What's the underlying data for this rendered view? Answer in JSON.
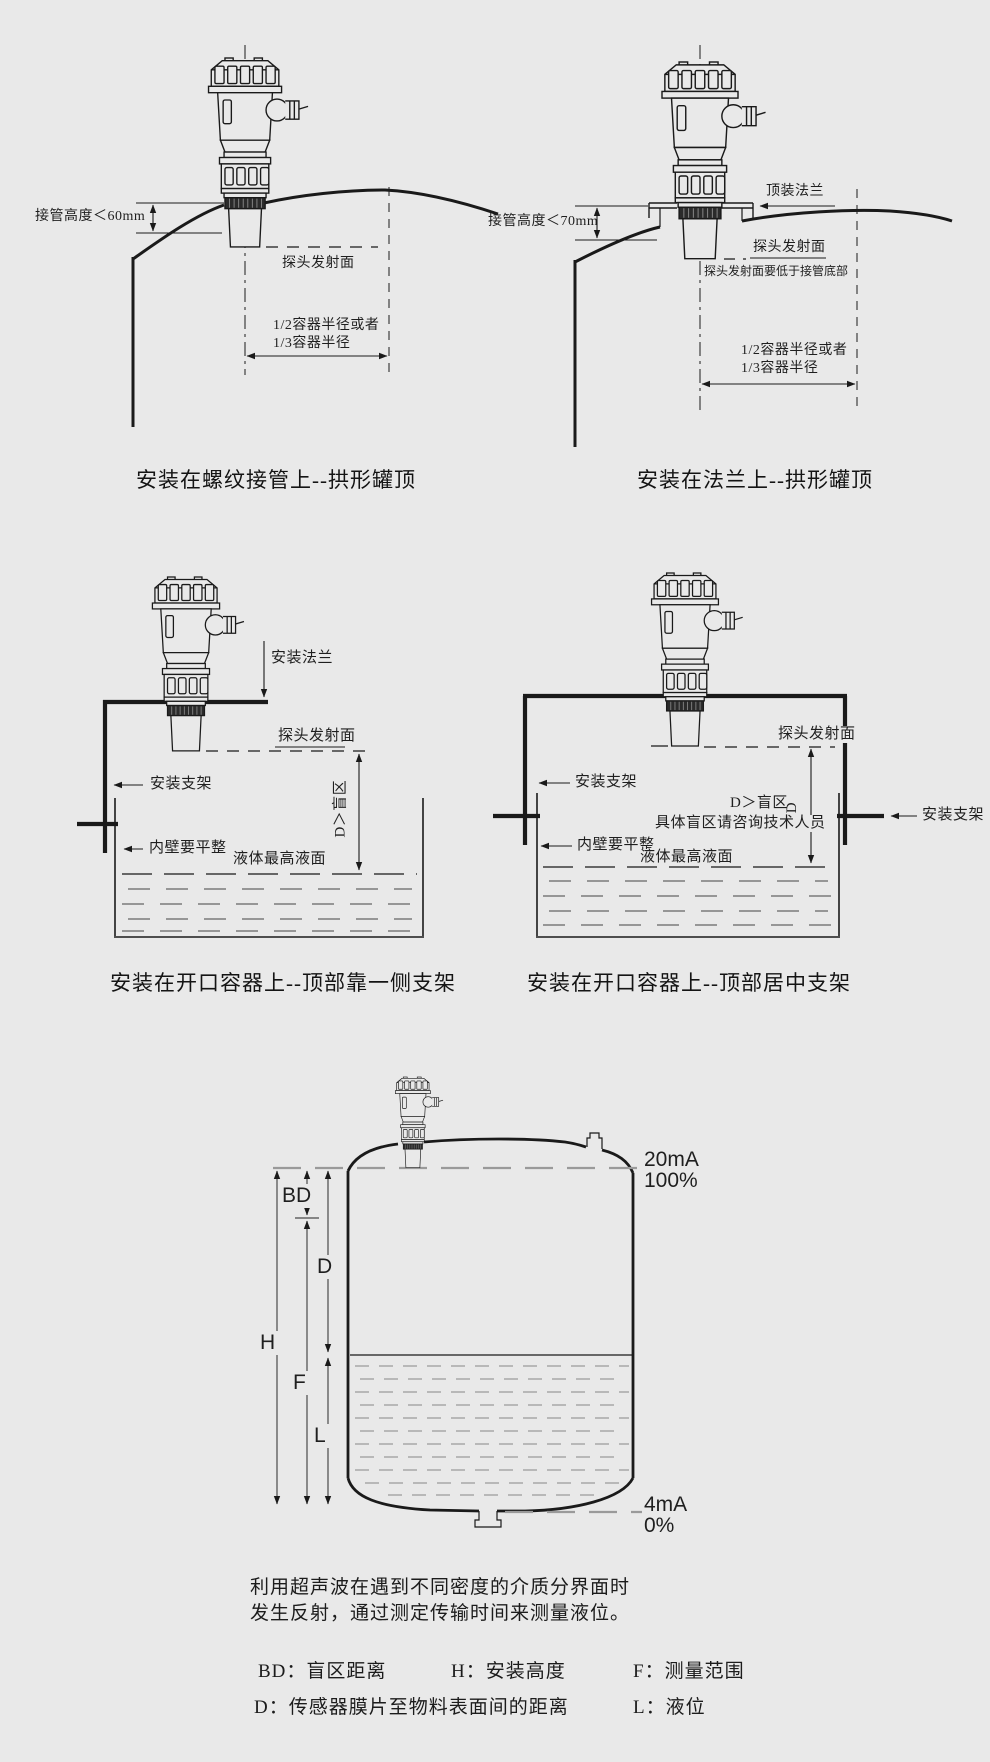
{
  "colors": {
    "background": "#e9e9e9",
    "line": "#1a1a1a",
    "text": "#1f1f1f"
  },
  "diagrams": {
    "top_left": {
      "caption": "安装在螺纹接管上--拱形罐顶",
      "pipe_height": "接管高度＜60mm",
      "probe_surface": "探头发射面",
      "radius_line1": "1/2容器半径或者",
      "radius_line2": "1/3容器半径"
    },
    "top_right": {
      "caption": "安装在法兰上--拱形罐顶",
      "top_flange": "顶装法兰",
      "pipe_height": "接管高度＜70mm",
      "probe_surface": "探头发射面",
      "probe_note": "探头发射面要低于接管底部",
      "radius_line1": "1/2容器半径或者",
      "radius_line2": "1/3容器半径"
    },
    "mid_left": {
      "caption": "安装在开口容器上--顶部靠一侧支架",
      "mount_flange": "安装法兰",
      "probe_surface": "探头发射面",
      "bracket": "安装支架",
      "blind_zone": "D＞盲区",
      "wall_note": "内壁要平整",
      "max_level": "液体最高液面"
    },
    "mid_right": {
      "caption": "安装在开口容器上--顶部居中支架",
      "probe_surface": "探头发射面",
      "bracket_left": "安装支架",
      "bracket_right": "安装支架",
      "blind_zone": "D＞盲区",
      "dim_d": "D",
      "blind_note": "具体盲区请咨询技术人员",
      "wall_note": "内壁要平整",
      "max_level": "液体最高液面"
    },
    "bottom": {
      "output_100_ma": "20mA",
      "output_100_pct": "100%",
      "output_0_ma": "4mA",
      "output_0_pct": "0%",
      "dim_bd": "BD",
      "dim_d": "D",
      "dim_h": "H",
      "dim_f": "F",
      "dim_l": "L"
    }
  },
  "description": {
    "line1": "利用超声波在遇到不同密度的介质分界面时",
    "line2": "发生反射，通过测定传输时间来测量液位。"
  },
  "legend": {
    "row1": [
      "BD：盲区距离",
      "H：安装高度",
      "F：测量范围"
    ],
    "row2": [
      "D：传感器膜片至物料表面间的距离",
      "L：液位"
    ]
  }
}
